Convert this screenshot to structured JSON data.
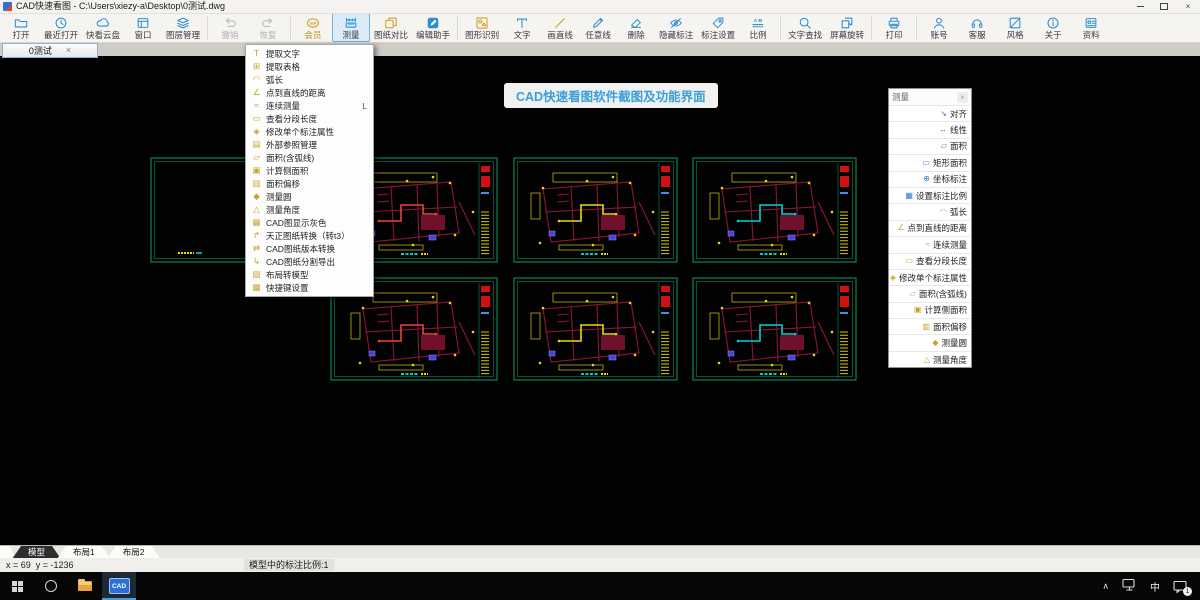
{
  "window": {
    "title": "CAD快速看图 - C:\\Users\\xiezy-a\\Desktop\\0测试.dwg"
  },
  "glyphs": {
    "close": "×",
    "chevron_up": "∧"
  },
  "toolbar": {
    "groups": [
      [
        {
          "key": "open",
          "label": "打开",
          "tone": "blue"
        },
        {
          "key": "recent-open",
          "label": "最近打开",
          "tone": "blue"
        },
        {
          "key": "cloud",
          "label": "快看云盘",
          "tone": "blue"
        },
        {
          "key": "window",
          "label": "窗口",
          "tone": "blue"
        },
        {
          "key": "layer-manager",
          "label": "图层管理",
          "tone": "blue"
        }
      ],
      [
        {
          "key": "undo",
          "label": "撤销",
          "tone": "disabled"
        },
        {
          "key": "redo",
          "label": "恢复",
          "tone": "disabled"
        }
      ],
      [
        {
          "key": "vip",
          "label": "会员",
          "tone": "gold",
          "gold_label": true
        },
        {
          "key": "measure",
          "label": "测量",
          "tone": "blue",
          "active": true
        },
        {
          "key": "compare",
          "label": "图纸对比",
          "tone": "gold"
        },
        {
          "key": "edit-assistant",
          "label": "编辑助手",
          "tone": "filled"
        }
      ],
      [
        {
          "key": "shape-recognition",
          "label": "图形识别",
          "tone": "gold"
        },
        {
          "key": "text",
          "label": "文字",
          "tone": "blue"
        },
        {
          "key": "draw-line",
          "label": "画直线",
          "tone": "gold"
        },
        {
          "key": "freehand-line",
          "label": "任意线",
          "tone": "blue"
        },
        {
          "key": "delete",
          "label": "删除",
          "tone": "blue"
        },
        {
          "key": "hide-annotation",
          "label": "隐藏标注",
          "tone": "blue"
        },
        {
          "key": "annotation-settings",
          "label": "标注设置",
          "tone": "blue"
        },
        {
          "key": "scale",
          "label": "比例",
          "tone": "blue"
        }
      ],
      [
        {
          "key": "text-search",
          "label": "文字查找",
          "tone": "blue"
        },
        {
          "key": "screen-rotate",
          "label": "屏幕旋转",
          "tone": "blue"
        }
      ],
      [
        {
          "key": "print",
          "label": "打印",
          "tone": "blue"
        }
      ],
      [
        {
          "key": "account",
          "label": "账号",
          "tone": "blue"
        },
        {
          "key": "support",
          "label": "客服",
          "tone": "blue"
        },
        {
          "key": "style",
          "label": "风格",
          "tone": "blue"
        },
        {
          "key": "about",
          "label": "关于",
          "tone": "blue"
        },
        {
          "key": "docs",
          "label": "资料",
          "tone": "blue"
        }
      ]
    ]
  },
  "doc_tab": {
    "label": "0测试"
  },
  "banner": {
    "text": "CAD快速看图软件截图及功能界面",
    "color": "#3b9fd8"
  },
  "context_menu": {
    "items": [
      {
        "label": "提取文字",
        "icon": "T"
      },
      {
        "label": "提取表格",
        "icon": "⊞"
      },
      {
        "label": "弧长",
        "icon": "◠"
      },
      {
        "label": "点到直线的距离",
        "icon": "∠"
      },
      {
        "label": "连续测量",
        "icon": "≈",
        "shortcut": "L"
      },
      {
        "label": "查看分段长度",
        "icon": "▭"
      },
      {
        "label": "修改单个标注属性",
        "icon": "◈"
      },
      {
        "label": "外部参照管理",
        "icon": "▤"
      },
      {
        "label": "面积(含弧线)",
        "icon": "▱"
      },
      {
        "label": "计算侧面积",
        "icon": "▣"
      },
      {
        "label": "面积偏移",
        "icon": "▥"
      },
      {
        "label": "测量圆",
        "icon": "◆"
      },
      {
        "label": "测量角度",
        "icon": "△"
      },
      {
        "label": "CAD图显示灰色",
        "icon": "▦"
      },
      {
        "label": "天正图纸转换（转t3）",
        "icon": "↱"
      },
      {
        "label": "CAD图纸版本转换",
        "icon": "⇄"
      },
      {
        "label": "CAD图纸分割导出",
        "icon": "↳"
      },
      {
        "label": "布局转模型",
        "icon": "▨"
      },
      {
        "label": "快捷键设置",
        "icon": "▩"
      }
    ]
  },
  "measure_panel": {
    "title": "测量",
    "items": [
      {
        "label": "对齐",
        "icon": "↘",
        "tone": "blue"
      },
      {
        "label": "线性",
        "icon": "↔",
        "tone": "blue"
      },
      {
        "label": "面积",
        "icon": "▱",
        "tone": "blue"
      },
      {
        "label": "矩形面积",
        "icon": "▭",
        "tone": "blue"
      },
      {
        "label": "坐标标注",
        "icon": "⊕",
        "tone": "blue"
      },
      {
        "label": "设置标注比例",
        "icon": "▦",
        "tone": "blue"
      },
      {
        "label": "弧长",
        "icon": "◠",
        "tone": "gold"
      },
      {
        "label": "点到直线的距离",
        "icon": "∠",
        "tone": "gold"
      },
      {
        "label": "连续测量",
        "icon": "≈",
        "tone": "gold"
      },
      {
        "label": "查看分段长度",
        "icon": "▭",
        "tone": "gold"
      },
      {
        "label": "修改单个标注属性",
        "icon": "◈",
        "tone": "gold"
      },
      {
        "label": "面积(含弧线)",
        "icon": "▱",
        "tone": "gold"
      },
      {
        "label": "计算侧面积",
        "icon": "▣",
        "tone": "gold"
      },
      {
        "label": "面积偏移",
        "icon": "▥",
        "tone": "gold"
      },
      {
        "label": "测量圆",
        "icon": "◆",
        "tone": "gold"
      },
      {
        "label": "测量角度",
        "icon": "△",
        "tone": "gold"
      }
    ]
  },
  "layout_tabs": {
    "items": [
      {
        "label": "模型",
        "active": true
      },
      {
        "label": "布局1",
        "active": false
      },
      {
        "label": "布局2",
        "active": false
      }
    ]
  },
  "status": {
    "coords": "x = 69  y = -1236",
    "scale": "模型中的标注比例:1"
  },
  "taskbar": {
    "input_indicator": "中",
    "notification_count": "1"
  },
  "colors": {
    "frame_green": "#0d8f55",
    "plan_maroon": "#8d1638",
    "accent_red": "#e8453c",
    "accent_yellow": "#e8dc00",
    "accent_cyan": "#00d2d2",
    "toolbar_blue": "#2a8fd0",
    "toolbar_gold": "#c9a227"
  },
  "canvas": {
    "thumbnails": [
      {
        "x": 150,
        "y": 101,
        "w": 348,
        "h": 106,
        "accent": "#e8453c",
        "wide": true
      },
      {
        "x": 513,
        "y": 101,
        "w": 165,
        "h": 106,
        "accent": "#e8dc00",
        "wide": false
      },
      {
        "x": 692,
        "y": 101,
        "w": 165,
        "h": 106,
        "accent": "#00d2d2",
        "wide": false
      },
      {
        "x": 330,
        "y": 221,
        "w": 168,
        "h": 104,
        "accent": "#e8453c",
        "wide": false
      },
      {
        "x": 513,
        "y": 221,
        "w": 165,
        "h": 104,
        "accent": "#e8dc00",
        "wide": false
      },
      {
        "x": 692,
        "y": 221,
        "w": 165,
        "h": 104,
        "accent": "#00d2d2",
        "wide": false
      }
    ]
  }
}
